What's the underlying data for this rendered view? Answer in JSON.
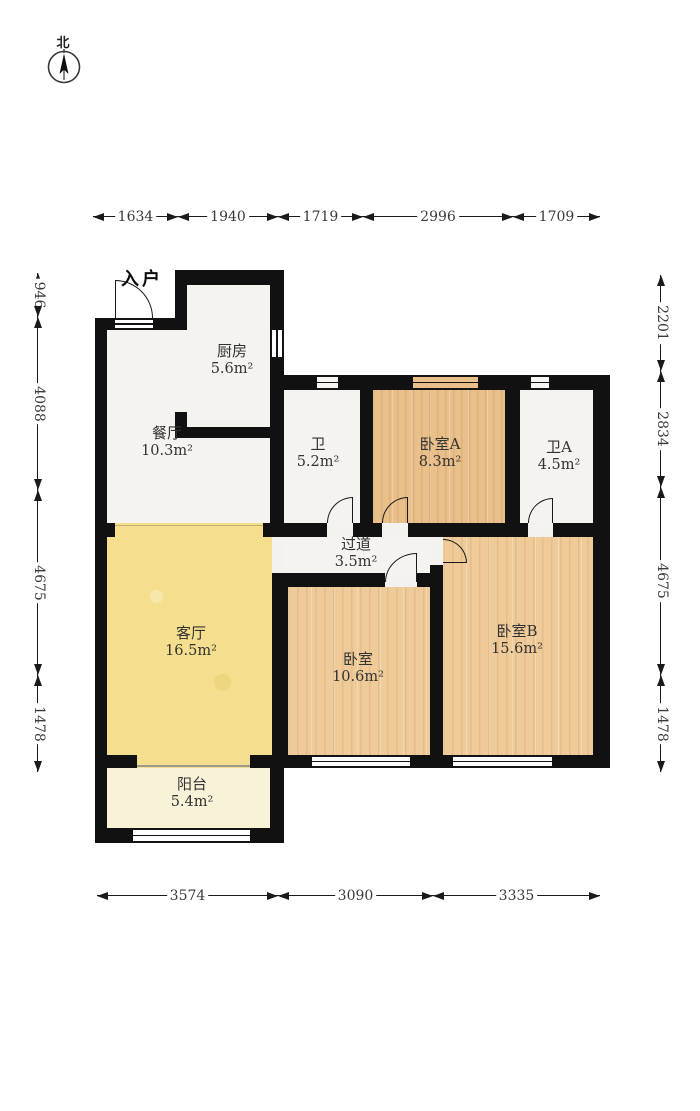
{
  "compass": {
    "north_label": "北"
  },
  "dims": {
    "top": [
      "1634",
      "1940",
      "1719",
      "2996",
      "1709"
    ],
    "bottom": [
      "3574",
      "3090",
      "3335"
    ],
    "left": [
      "946",
      "4088",
      "4675",
      "1478"
    ],
    "right": [
      "2201",
      "2834",
      "4675",
      "1478"
    ]
  },
  "rooms": {
    "entry": {
      "name": "入户"
    },
    "kitchen": {
      "name": "厨房",
      "area": "5.6m²"
    },
    "dining": {
      "name": "餐厅",
      "area": "10.3m²"
    },
    "bath": {
      "name": "卫",
      "area": "5.2m²"
    },
    "bedroomA": {
      "name": "卧室A",
      "area": "8.3m²"
    },
    "bathA": {
      "name": "卫A",
      "area": "4.5m²"
    },
    "hallway": {
      "name": "过道",
      "area": "3.5m²"
    },
    "living": {
      "name": "客厅",
      "area": "16.5m²"
    },
    "bedroom": {
      "name": "卧室",
      "area": "10.6m²"
    },
    "bedroomB": {
      "name": "卧室B",
      "area": "15.6m²"
    },
    "balcony": {
      "name": "阳台",
      "area": "5.4m²"
    }
  },
  "colors": {
    "wall": "#111111",
    "living_floor": "#f5df8e",
    "wood_floor": "#eecb99",
    "woodA_floor": "#e9bf8a",
    "balcony_floor": "#f8f2d8",
    "white_floor": "#f3f2ee"
  }
}
